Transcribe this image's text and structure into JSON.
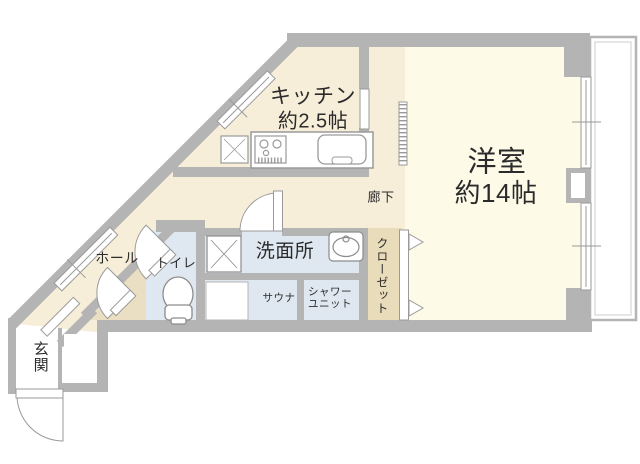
{
  "floorplan": {
    "labels": {
      "kitchen_name": "キッチン",
      "kitchen_size": "約2.5帖",
      "western_room_name": "洋室",
      "western_room_size": "約14帖",
      "corridor": "廊下",
      "washroom": "洗面所",
      "sauna": "サウナ",
      "shower_line1": "シャワー",
      "shower_line2": "ユニット",
      "closet": "クローゼット",
      "toilet": "トイレ",
      "hall": "ホール",
      "entrance": "玄関"
    },
    "colors": {
      "wall": "#b4b4b4",
      "western_room_floor": "#fdfae8",
      "kitchen_hall_floor": "#f7eed9",
      "wet_area_floor": "#dfe8f0",
      "closet_floor": "#e8dcba",
      "fixture_line": "#9a9a9a",
      "text": "#2b2b2b"
    }
  }
}
